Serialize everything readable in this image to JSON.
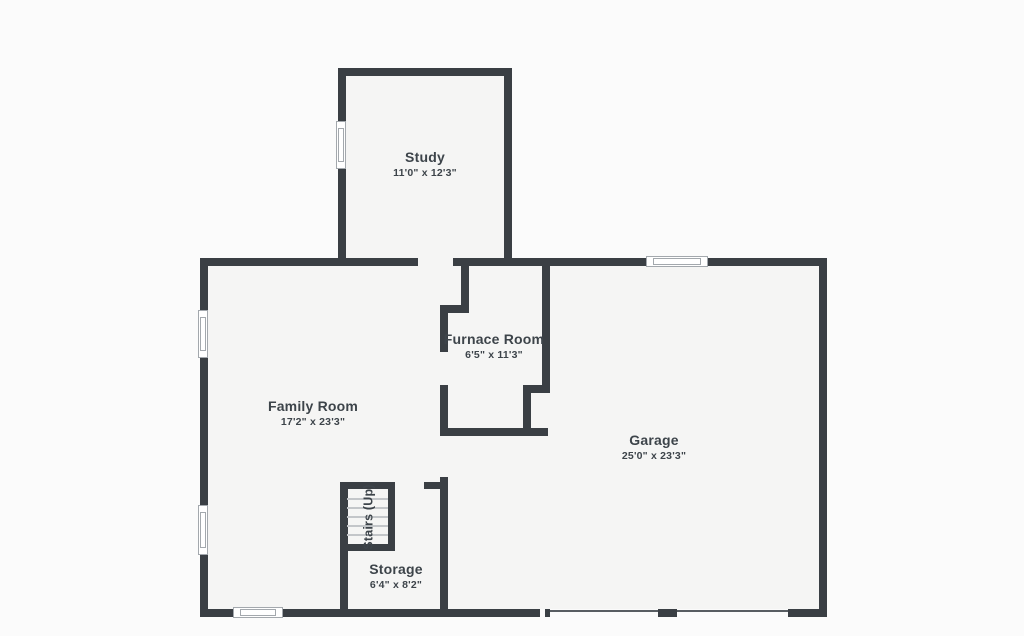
{
  "colors": {
    "wall": "#3a3f44",
    "room_fill": "#f5f5f4",
    "background": "#fbfbfb",
    "text": "#3d444a",
    "window_frame": "#a3a8ad"
  },
  "rooms": [
    {
      "id": "study",
      "label": "Study",
      "dims": "11'0\" x 12'3\""
    },
    {
      "id": "family-room",
      "label": "Family Room",
      "dims": "17'2\" x 23'3\""
    },
    {
      "id": "furnace-room",
      "label": "Furnace Room",
      "dims": "6'5\" x 11'3\""
    },
    {
      "id": "garage",
      "label": "Garage",
      "dims": "25'0\" x 23'3\""
    },
    {
      "id": "storage",
      "label": "Storage",
      "dims": "6'4\" x 8'2\""
    },
    {
      "id": "stairs",
      "label": "Stairs (Up)"
    }
  ],
  "plan_geometry": {
    "walls": [
      {
        "id": "study-top",
        "rect": [
          338,
          68,
          174,
          8
        ]
      },
      {
        "id": "study-left",
        "rect": [
          338,
          68,
          8,
          198
        ]
      },
      {
        "id": "study-right",
        "rect": [
          504,
          68,
          8,
          198
        ]
      },
      {
        "id": "main-top-left",
        "rect": [
          200,
          258,
          218,
          8
        ]
      },
      {
        "id": "main-top-right",
        "rect": [
          453,
          258,
          374,
          8
        ]
      },
      {
        "id": "main-left",
        "rect": [
          200,
          258,
          8,
          359
        ]
      },
      {
        "id": "main-right",
        "rect": [
          819,
          258,
          8,
          359
        ]
      },
      {
        "id": "main-bottom-left",
        "rect": [
          200,
          609,
          340,
          8
        ]
      },
      {
        "id": "garage-door-jamb",
        "rect": [
          545,
          609,
          5,
          8
        ]
      },
      {
        "id": "garage-center-post",
        "rect": [
          658,
          609,
          19,
          8
        ]
      },
      {
        "id": "main-bottom-right",
        "rect": [
          788,
          609,
          39,
          8
        ]
      },
      {
        "id": "furnace-upper-left-v",
        "rect": [
          461,
          266,
          8,
          47
        ]
      },
      {
        "id": "furnace-jog-h",
        "rect": [
          440,
          305,
          29,
          8
        ]
      },
      {
        "id": "furnace-left-upper",
        "rect": [
          440,
          305,
          8,
          47
        ]
      },
      {
        "id": "furnace-left-lower",
        "rect": [
          440,
          385,
          8,
          51
        ]
      },
      {
        "id": "furnace-bottom",
        "rect": [
          440,
          428,
          108,
          8
        ]
      },
      {
        "id": "furnace-right",
        "rect": [
          542,
          266,
          8,
          127
        ]
      },
      {
        "id": "furnace-jog2-h",
        "rect": [
          523,
          385,
          27,
          8
        ]
      },
      {
        "id": "furnace-jog2-v",
        "rect": [
          523,
          385,
          8,
          51
        ]
      },
      {
        "id": "storage-left",
        "rect": [
          340,
          482,
          8,
          135
        ]
      },
      {
        "id": "stairs-top",
        "rect": [
          340,
          482,
          55,
          7
        ]
      },
      {
        "id": "stairs-right",
        "rect": [
          388,
          482,
          7,
          69
        ]
      },
      {
        "id": "stairs-bottom",
        "rect": [
          340,
          544,
          55,
          7
        ]
      },
      {
        "id": "storage-top-segment",
        "rect": [
          424,
          482,
          24,
          7
        ]
      },
      {
        "id": "storage-right",
        "rect": [
          440,
          477,
          8,
          140
        ]
      }
    ],
    "windows": [
      {
        "id": "study-left-window",
        "rect": [
          336,
          121,
          10,
          48
        ]
      },
      {
        "id": "family-left-window-1",
        "rect": [
          198,
          310,
          10,
          48
        ]
      },
      {
        "id": "family-left-window-2",
        "rect": [
          198,
          505,
          10,
          50
        ]
      },
      {
        "id": "family-bottom-window",
        "rect": [
          233,
          607,
          50,
          11
        ]
      },
      {
        "id": "garage-top-window",
        "rect": [
          646,
          256,
          62,
          11
        ]
      }
    ],
    "garage_door_sills": [
      [
        550,
        610,
        108,
        2
      ],
      [
        677,
        610,
        111,
        2
      ]
    ],
    "stair_treads": [
      [
        347,
        498,
        41,
        2
      ],
      [
        347,
        507,
        41,
        2
      ],
      [
        347,
        516,
        41,
        2
      ],
      [
        347,
        525,
        41,
        2
      ],
      [
        347,
        534,
        41,
        2
      ]
    ]
  }
}
